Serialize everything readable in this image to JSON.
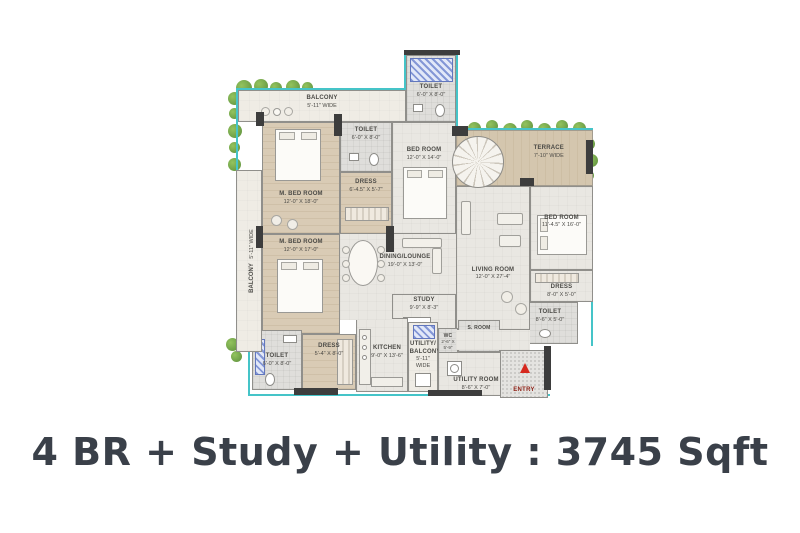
{
  "title": "4 BR + Study + Utility : 3745 Sqft",
  "colors": {
    "boundary_teal": "#45c4c8",
    "plant_green": "#6fa14f",
    "bedroom_floor_beige": "#d9cbb5",
    "common_floor_gray": "#e9e7e2",
    "wall_dark": "#3d3d3d",
    "entry_arrow_red": "#d6281e",
    "title_color": "#3a4049"
  },
  "floorplan": {
    "entry_label": "ENTRY",
    "rooms": [
      {
        "id": "balcony-top",
        "name": "BALCONY",
        "dims": "5'-11\" WIDE"
      },
      {
        "id": "toilet-top",
        "name": "TOILET",
        "dims": "6'-0\" X 8'-0\""
      },
      {
        "id": "m-bedroom-1",
        "name": "M. BED ROOM",
        "dims": "12'-0\" X 18'-0\""
      },
      {
        "id": "toilet-mid",
        "name": "TOILET",
        "dims": "6'-0\" X 8'-0\""
      },
      {
        "id": "dress-mid",
        "name": "DRESS",
        "dims": "6'-4.5\" X 5'-7\""
      },
      {
        "id": "bedroom-2",
        "name": "BED ROOM",
        "dims": "12'-0\" X 14'-0\""
      },
      {
        "id": "terrace",
        "name": "TERRACE",
        "dims": "7'-10\" WIDE"
      },
      {
        "id": "bedroom-3",
        "name": "BED ROOM",
        "dims": "11'-4.5\" X 16'-0\""
      },
      {
        "id": "dress-right",
        "name": "DRESS",
        "dims": "8'-0\" X 5'-0\""
      },
      {
        "id": "toilet-right",
        "name": "TOILET",
        "dims": "8'-6\" X 5'-0\""
      },
      {
        "id": "dining-lounge",
        "name": "DINING/LOUNGE",
        "dims": "19'-0\" X 13'-0\""
      },
      {
        "id": "living-room",
        "name": "LIVING ROOM",
        "dims": "12'-0\" X 27'-4\""
      },
      {
        "id": "study",
        "name": "STUDY",
        "dims": "9'-9\" X 8'-3\""
      },
      {
        "id": "m-bedroom-2",
        "name": "M. BED ROOM",
        "dims": "12'-0\" X 17'-0\""
      },
      {
        "id": "toilet-bl",
        "name": "TOILET",
        "dims": "6'-0\" X 8'-0\""
      },
      {
        "id": "dress-bl",
        "name": "DRESS",
        "dims": "5'-4\" X 8'-0\""
      },
      {
        "id": "kitchen",
        "name": "KITCHEN",
        "dims": "9'-0\" X 13'-6\""
      },
      {
        "id": "utility-balcony",
        "name": "UTILITY/ BALCONY",
        "dims": "5'-11\" WIDE"
      },
      {
        "id": "wc",
        "name": "WC",
        "dims": "2'-6\" X 5'-9\""
      },
      {
        "id": "s-room",
        "name": "S. ROOM",
        "dims": "4'-4.5\" X 5'-0\""
      },
      {
        "id": "utility-room",
        "name": "UTILITY ROOM",
        "dims": "8'-6\" X 7'-0\""
      },
      {
        "id": "balcony-left",
        "name": "BALCONY",
        "dims": "5'-11\" WIDE"
      }
    ]
  }
}
